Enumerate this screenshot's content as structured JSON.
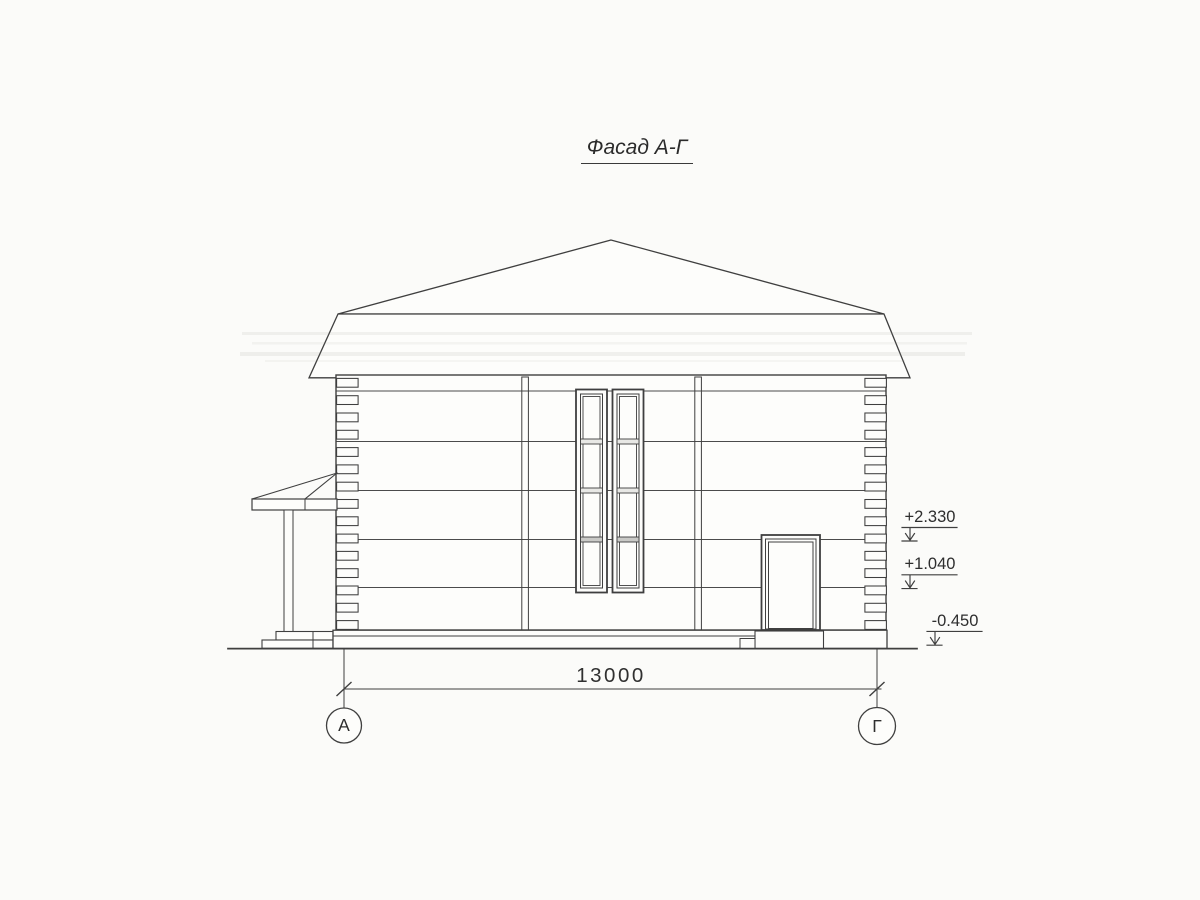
{
  "drawing": {
    "title": "Фасад А-Г",
    "dimension_label": "13000",
    "elevation_marks": [
      {
        "value": "+2.330"
      },
      {
        "value": "+1.040"
      },
      {
        "value": "-0.450"
      }
    ],
    "axis_markers": [
      {
        "label": "А"
      },
      {
        "label": "Г"
      }
    ],
    "colors": {
      "line": "#3f3f3f",
      "paper": "#fbfbf9",
      "fill": "#fdfdfb"
    }
  }
}
